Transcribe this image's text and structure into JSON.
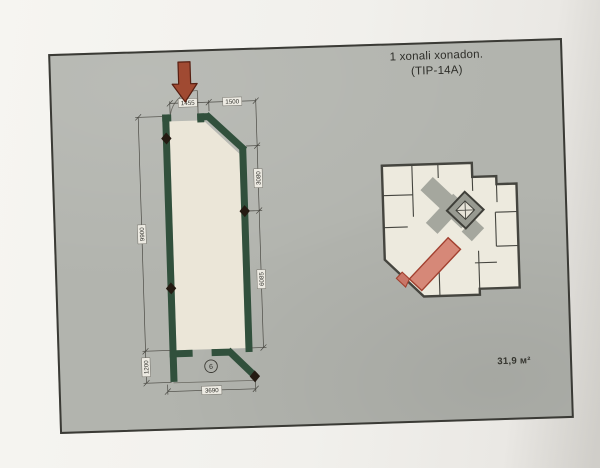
{
  "sheet": {
    "title_line1": "1 xonali xonadon.",
    "title_line2": "(TIP-14A)",
    "area_label": "31,9 м²"
  },
  "plan": {
    "room_number": "6",
    "dim_top_left": "1455",
    "dim_top_right": "1500",
    "dim_right_upper": "3080",
    "dim_right_lower": "6085",
    "dim_left_main": "9900",
    "dim_left_balcony": "1200",
    "dim_bottom": "3690"
  },
  "colors": {
    "sheet_background": "#b2b4ae",
    "paper": "#f1f0ec",
    "frame_border": "#3a3a35",
    "wall_green": "#31503c",
    "floor_cream": "#ebe6d8",
    "arrow_red": "#a04a32",
    "arrow_outline": "#571f12",
    "dimension_ink": "#45443e",
    "marker_black": "#241a12",
    "keyplan_wall": "#45453f",
    "keyplan_room": "#edeade",
    "keyplan_corridor": "#a5a79e",
    "highlight_fill": "#d68878",
    "highlight_outline": "#a2402f"
  }
}
